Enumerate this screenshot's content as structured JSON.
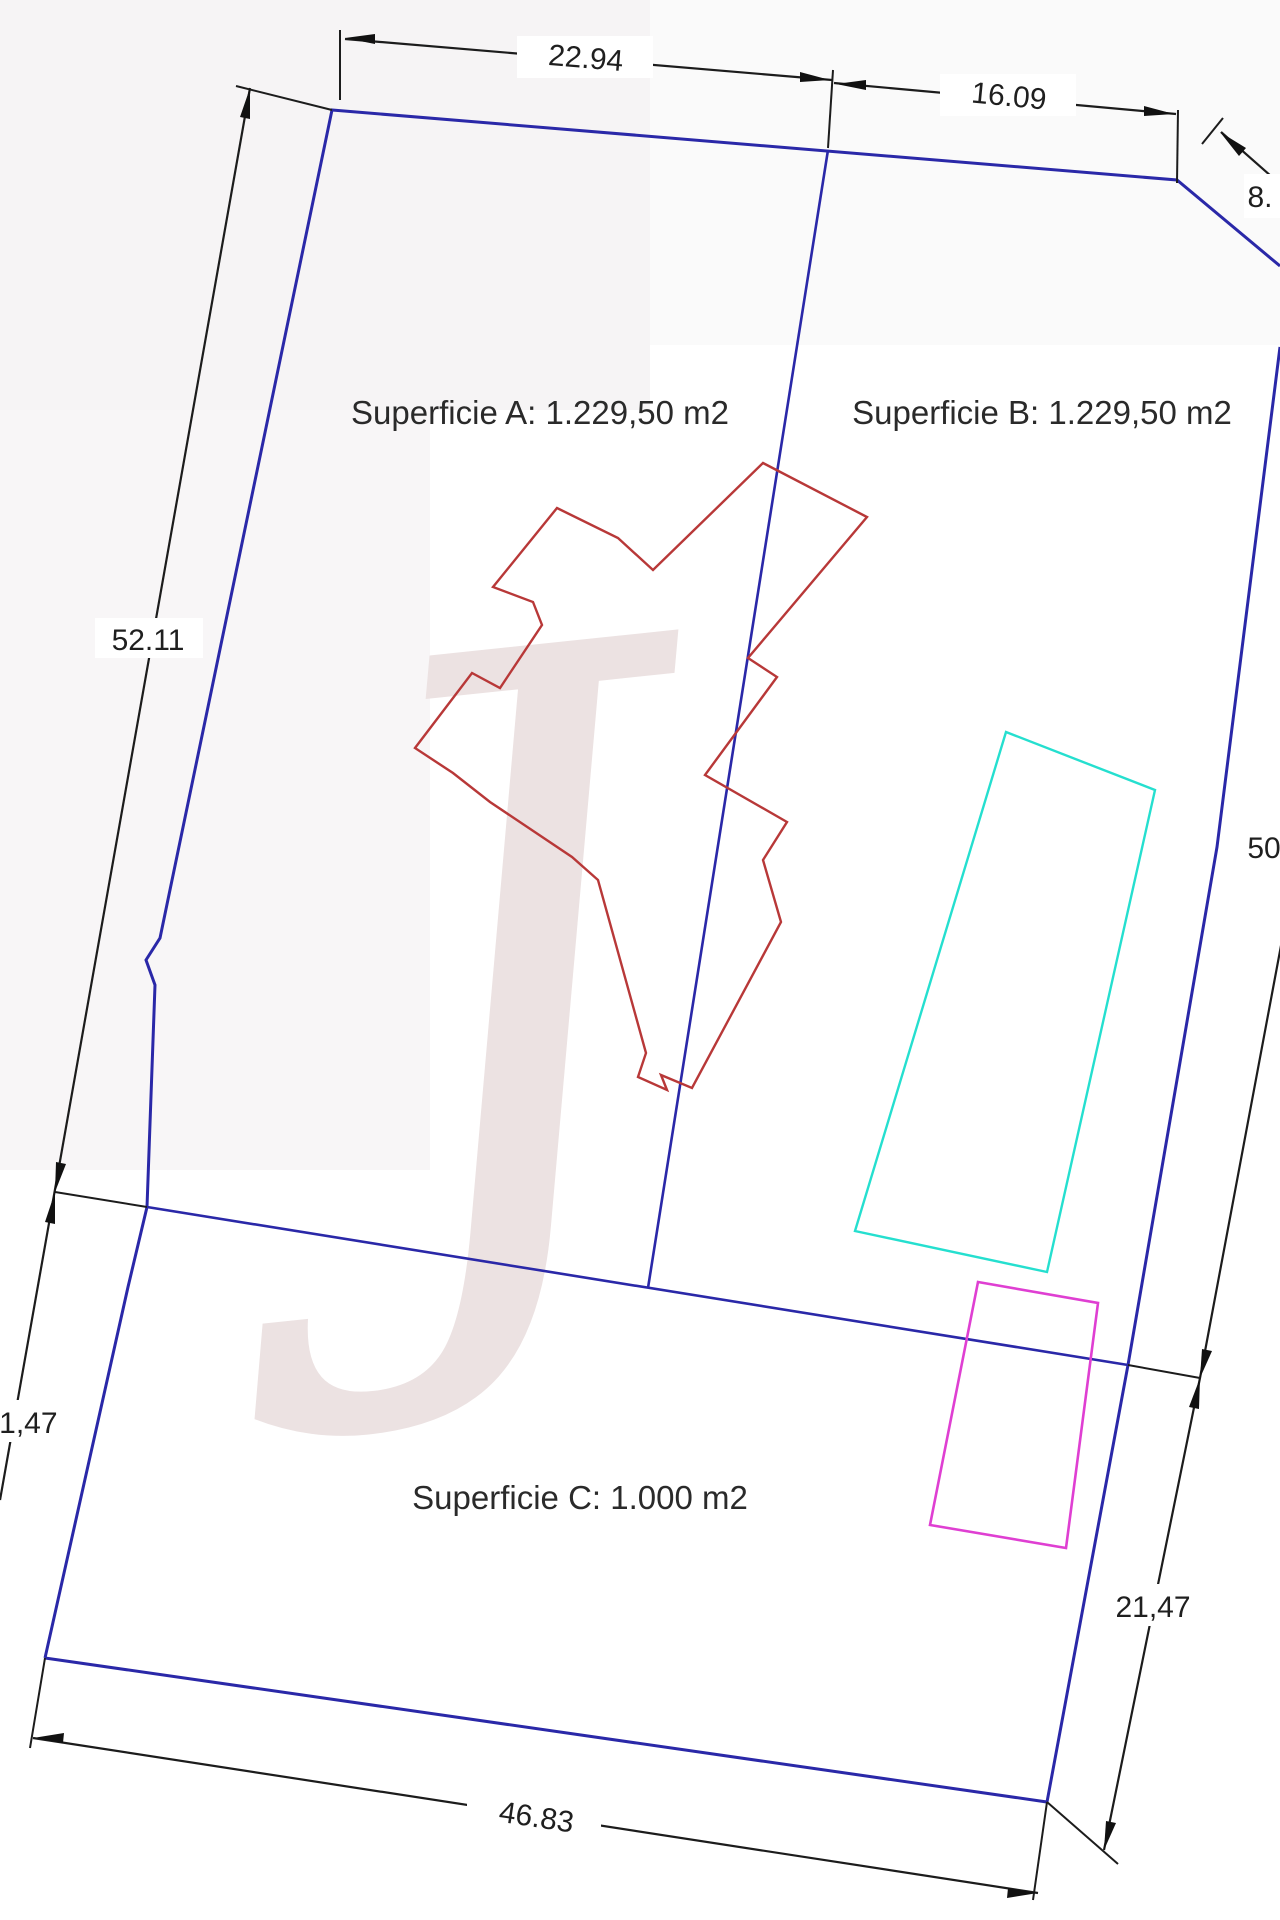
{
  "parcels": {
    "a": {
      "label": "Superficie A: 1.229,50 m2"
    },
    "b": {
      "label": "Superficie B: 1.229,50 m2"
    },
    "c": {
      "label": "Superficie C: 1.000 m2"
    }
  },
  "dimensions": {
    "top_left_width": "22.94",
    "top_right_width": "16.09",
    "top_diagonal": "8.",
    "left_upper_height": "52.11",
    "right_upper_height": "50",
    "left_lower_height": "21,47",
    "right_lower_height": "21,47",
    "bottom_width": "46.83"
  },
  "watermark": {
    "glyph": "J"
  },
  "colors": {
    "boundary_blue": "#2a28a8",
    "dimension_black": "#1c1c1c",
    "building_red": "#b83838",
    "pool_cyan": "#25dfcf",
    "annex_magenta": "#df3fd2",
    "watermark_pink": "#ece2e2"
  },
  "shapes": {
    "boundary_left_top": "45,1658 128,1287 147,1207 155,985 146,960 160,938 332,110 1177,180 1280,266",
    "boundary_right_bottom": "1280,347 1217,847 1128,1365 1047,1802 45,1658",
    "divider_ab": "828,150 648,1288",
    "divider_bc": "147,1207 1128,1365",
    "ext_bc_left": "55,1192 147,1207",
    "ext_bc_right": "1128,1365 1200,1378",
    "dim_top1": "345,39 832,80",
    "dim_top2": "834,83 1176,114",
    "dim_diag8": "1221,132 1280,184",
    "dim_left": "250,88 0,1500",
    "dim_right": "1283,935 1200,1378 1104,1850",
    "dim_bottom": "33,1738 1038,1893",
    "tick_top_left": "340,30 340,100",
    "tick_top_mid": "828,148 833,70",
    "tick_top_right": "1178,110 1177,183",
    "tick_diag": "1223,118 1202,144",
    "ext_corner_tl": "332,110 236,86",
    "ext_corner_bl": "45,1658 30,1748",
    "ext_corner_br_bottom": "1047,1802 1033,1900",
    "ext_corner_br_right": "1047,1802 1118,1864",
    "arrow_2294_left": "345,38 375,34 375,44",
    "arrow_2294_right": "830,80 800,72 800,82",
    "arrow_1609_left": "836,84 866,80 866,90",
    "arrow_1609_right": "1174,114 1144,106 1144,116",
    "arrow_8_diag": "1220,132 1246,148 1239,156",
    "arrow_left_top": "250,88 250,119 240,117",
    "arrow_left_junction_down": "55,1192 66,1164 56,1162",
    "arrow_left_junction_up": "55,1192 55,1224 45,1222",
    "arrow_right_junction_down": "1200,1378 1212,1351 1202,1349",
    "arrow_right_junction_up": "1200,1378 1199,1409 1189,1407",
    "arrow_right_bottom": "1104,1850 1116,1823 1106,1821",
    "arrow_bottom_left": "33,1738 64,1733 63,1743",
    "arrow_bottom_right": "1038,1893 1008,1888 1007,1898",
    "red_building": "763,463 867,517 748,658 777,677 705,775 787,822 763,860 781,922 692,1088 661,1075 667,1090 638,1077 646,1053 598,880 572,857 490,802 453,773 415,748 472,673 500,688 542,625 533,602 493,587 557,508 618,538 653,570",
    "cyan_rect": "1006,732 1155,790 1047,1272 855,1231",
    "magenta_rect": "978,1282 1098,1303 1066,1548 930,1525"
  }
}
